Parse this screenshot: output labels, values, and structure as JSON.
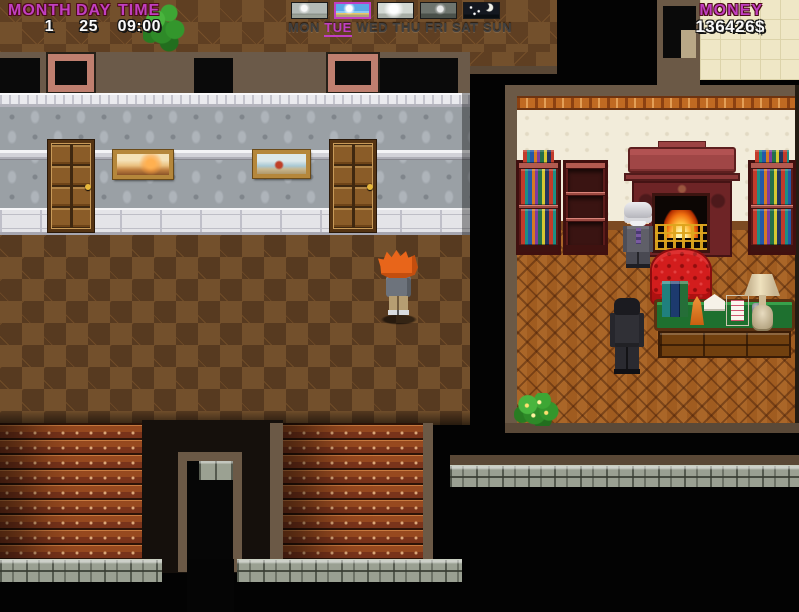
{
  "hud": {
    "calendar": {
      "month_label": "MONTH",
      "day_label": "DAY",
      "time_label": "TIME",
      "month_value": "1",
      "day_value": "25",
      "time_value": "09:00"
    },
    "forecast": {
      "icons": [
        "overcast",
        "sunny",
        "bright",
        "dim",
        "night"
      ],
      "selected_index": 1
    },
    "week": {
      "days": [
        "MON",
        "TUE",
        "WED",
        "THU",
        "FRI",
        "SAT",
        "SUN"
      ],
      "active_day": "TUE"
    },
    "money": {
      "label": "MONEY",
      "value": "136426$"
    }
  },
  "colors": {
    "hud_label_magenta": "#c13fc1",
    "hud_value_white": "#fafafa",
    "day_inactive": "#3f3f3f",
    "hall_floor_brown": "#6f4c29",
    "study_wall_cream": "#f2ecda",
    "study_floor_parquet": "#a05c20",
    "armchair_red": "#d31d1d",
    "stair_red": "#97491f",
    "stone_gray": "#9aa092"
  },
  "scene": {
    "sprites": [
      "player-character",
      "elderly-man-npc",
      "suited-man-npc",
      "hallway-door",
      "painting-sunset",
      "painting-seascape",
      "bookshelf-filled",
      "bookshelf-empty",
      "fireplace",
      "red-armchair",
      "writing-desk",
      "table-lamp",
      "note-paper",
      "envelope",
      "desk-books",
      "ink-pot",
      "potted-plant",
      "flowering-bush",
      "staircase-left",
      "staircase-middle",
      "stone-ledge",
      "lower-door-frame"
    ]
  }
}
